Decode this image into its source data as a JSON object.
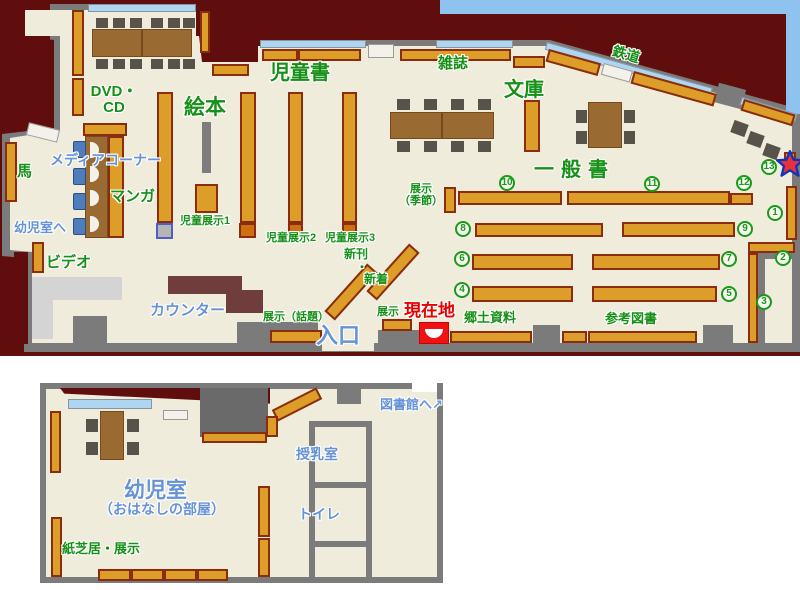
{
  "palette": {
    "outside": "#5f0d0d",
    "floor": "#efecdc",
    "wall": "#7b7b7b",
    "window": "#aed6f2",
    "sky_band": "#8fc3ef",
    "shelf": "#dc9e28",
    "shelf_border": "#8a2d0e",
    "table": "#9a6a33",
    "chair": "#57534a",
    "blue_chair": "#4f7cba",
    "counter": "#6f3d3b",
    "label_green": "#169016",
    "label_blue": "#6593d6",
    "label_red": "#e60000",
    "marker_red": "#ee1414",
    "star_fill": "#e83038",
    "star_stroke": "#1133bb"
  },
  "main": {
    "sections": {
      "dvd_line1": "DVD・",
      "dvd_line2": "CD",
      "ehon": "絵本",
      "jidosho": "児童書",
      "zasshi": "雑誌",
      "bunko": "文庫",
      "tetsudo": "鉄道",
      "ippansho": "一般書",
      "media": "メディアコーナー",
      "manga": "マンガ",
      "uma": "馬",
      "yojishitsu_e": "幼児室へ",
      "video": "ビデオ"
    },
    "features": {
      "counter": "カウンター",
      "iriguchi": "入口",
      "genzaichi": "現在地",
      "kyodo": "郷土資料",
      "sanko": "参考図書",
      "tenji": "展示",
      "tenji_wadai": "展示（話題）",
      "tenji_kisetsu1": "展示",
      "tenji_kisetsu2": "（季節）",
      "jido1": "児童展示1",
      "jido2": "児童展示2",
      "jido3": "児童展示3",
      "shinkan": "新刊",
      "nakaguro": "・",
      "shinchaku": "新着"
    },
    "circles": {
      "c1": "1",
      "c2": "2",
      "c3": "3",
      "c4": "4",
      "c5": "5",
      "c6": "6",
      "c7": "7",
      "c8": "8",
      "c9": "9",
      "c10": "10",
      "c11": "11",
      "c12": "12",
      "c13": "13"
    }
  },
  "annex": {
    "yojishitsu": "幼児室",
    "ohanashi": "（おはなしの部屋）",
    "kamishibai": "紙芝居・展示",
    "junyu": "授乳室",
    "toire": "トイレ",
    "toshokan": "図書館へ",
    "arrow": "↗"
  }
}
